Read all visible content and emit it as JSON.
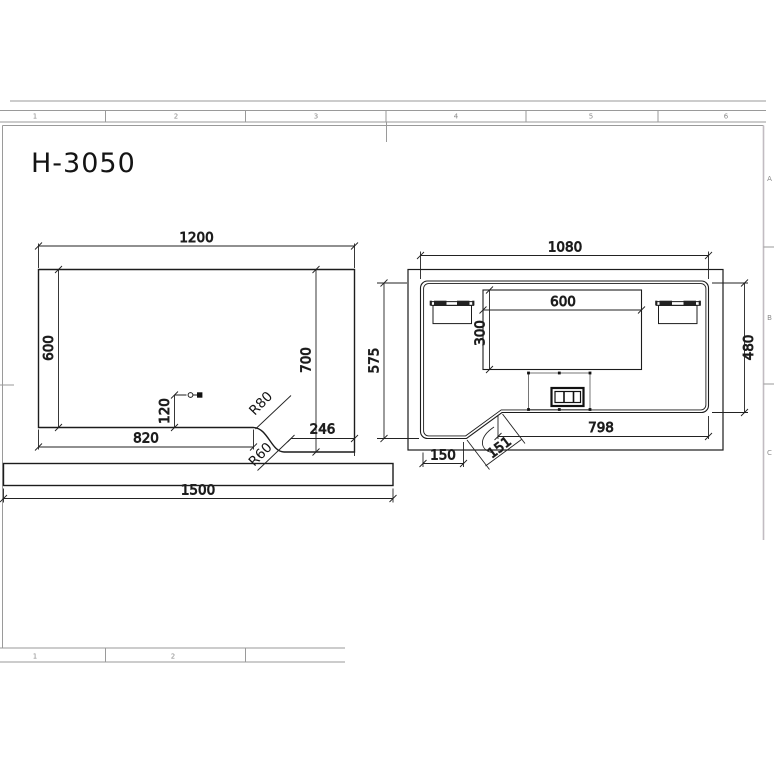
{
  "title": "H-3050",
  "sheet": {
    "top_zones": [
      "1",
      "2",
      "3",
      "4",
      "5",
      "6"
    ],
    "bottom_zones": [
      "1",
      "2"
    ],
    "right_zones": [
      "A",
      "B",
      "C"
    ]
  },
  "front_view": {
    "overall_width": "1200",
    "left_height": "600",
    "right_height": "700",
    "grommet_offset": "120",
    "bottom_left_width": "820",
    "bottom_right_width": "246",
    "top_radius": "R80",
    "bottom_radius": "R60"
  },
  "plank": {
    "length": "1500"
  },
  "plan_view": {
    "overall_width": "1080",
    "tray_width": "600",
    "tray_depth": "300",
    "left_depth": "575",
    "right_depth": "480",
    "bottom_width": "798",
    "notch_width": "150",
    "notch_edge": "151"
  }
}
